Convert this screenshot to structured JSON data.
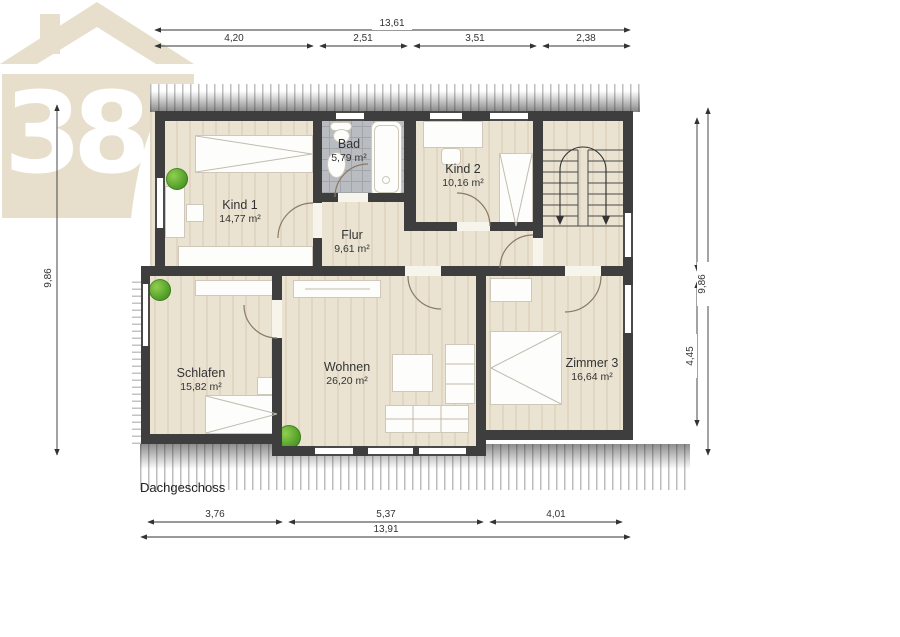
{
  "floor": {
    "label": "Dachgeschoss"
  },
  "logo": {
    "text": "38"
  },
  "rooms": [
    {
      "name": "Kind 1",
      "area": "14,77 m²"
    },
    {
      "name": "Bad",
      "area": "5,79 m²"
    },
    {
      "name": "Kind 2",
      "area": "10,16 m²"
    },
    {
      "name": "Flur",
      "area": "9,61 m²"
    },
    {
      "name": "Schlafen",
      "area": "15,82 m²"
    },
    {
      "name": "Wohnen",
      "area": "26,20 m²"
    },
    {
      "name": "Zimmer 3",
      "area": "16,64 m²"
    }
  ],
  "dimensions": {
    "top": {
      "total": "13,61",
      "segments": [
        "4,20",
        "2,51",
        "3,51",
        "2,38"
      ]
    },
    "bottom": {
      "total": "13,91",
      "segments": [
        "3,76",
        "5,37",
        "4,01"
      ]
    },
    "left": {
      "height": "9,86"
    },
    "right": {
      "height": "9,86",
      "segment": "4,45"
    }
  },
  "colors": {
    "wall": "#3e3e3e",
    "floor": "#ebe3d2",
    "tiles": "#b9bcc0",
    "logo": "#e7dfcc",
    "plant": "#55a02a"
  }
}
